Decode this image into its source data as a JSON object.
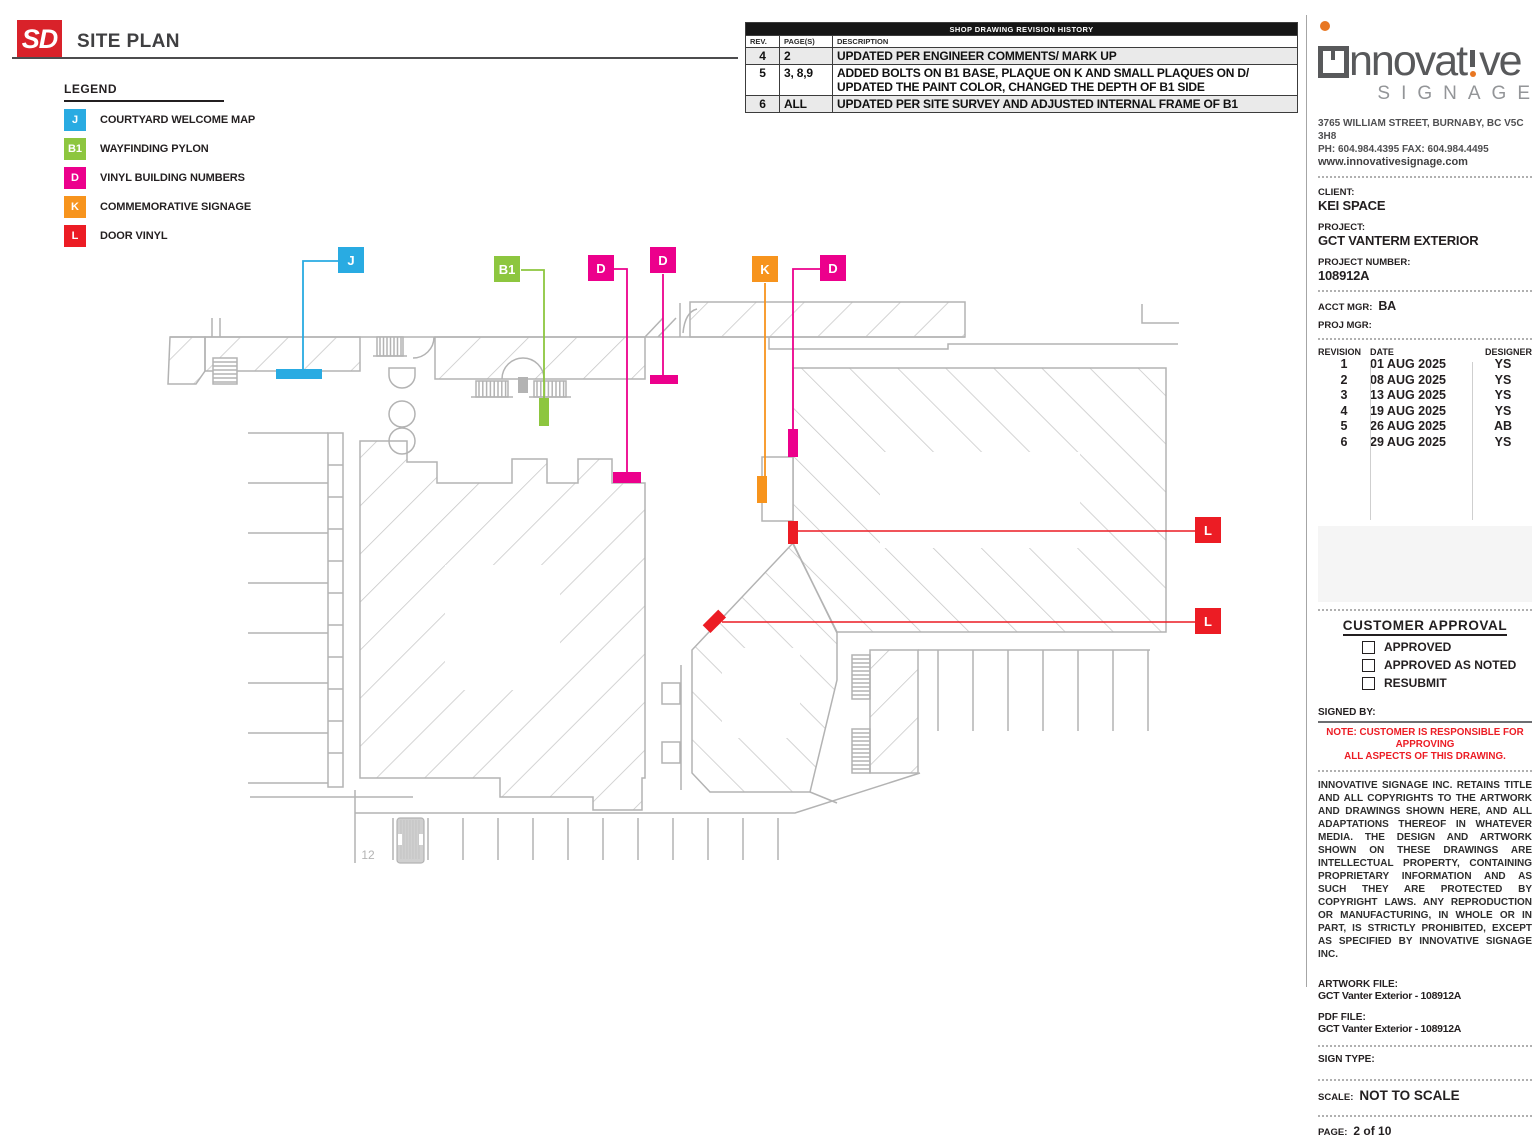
{
  "header": {
    "badge": "SD",
    "title": "SITE PLAN"
  },
  "legend": {
    "title": "LEGEND",
    "items": [
      {
        "code": "J",
        "label": "COURTYARD WELCOME MAP",
        "color": "#29ABE2"
      },
      {
        "code": "B1",
        "label": "WAYFINDING PYLON",
        "color": "#8DC63F"
      },
      {
        "code": "D",
        "label": "VINYL BUILDING NUMBERS",
        "color": "#EC008C"
      },
      {
        "code": "K",
        "label": "COMMEMORATIVE SIGNAGE",
        "color": "#F7941D"
      },
      {
        "code": "L",
        "label": "DOOR VINYL",
        "color": "#EC1C24"
      }
    ]
  },
  "revision_history": {
    "title": "SHOP DRAWING REVISION HISTORY",
    "columns": [
      "REV.",
      "PAGE(S)",
      "DESCRIPTION"
    ],
    "rows": [
      {
        "rev": "4",
        "pages": "2",
        "description": "UPDATED PER ENGINEER COMMENTS/ MARK UP"
      },
      {
        "rev": "5",
        "pages": "3, 8,9",
        "description": "ADDED BOLTS ON B1 BASE, PLAQUE ON K AND SMALL PLAQUES ON D/ UPDATED THE PAINT COLOR, CHANGED THE DEPTH OF B1 SIDE"
      },
      {
        "rev": "6",
        "pages": "ALL",
        "description": "UPDATED PER SITE SURVEY AND ADJUSTED INTERNAL FRAME OF B1"
      }
    ]
  },
  "plan": {
    "stall_number": "12",
    "markers": [
      {
        "code": "J",
        "x": 338,
        "y": 247
      },
      {
        "code": "B1",
        "x": 494,
        "y": 256
      },
      {
        "code": "D",
        "x": 588,
        "y": 255
      },
      {
        "code": "D",
        "x": 650,
        "y": 247
      },
      {
        "code": "K",
        "x": 752,
        "y": 256
      },
      {
        "code": "D",
        "x": 820,
        "y": 255
      },
      {
        "code": "L",
        "x": 1195,
        "y": 517
      },
      {
        "code": "L",
        "x": 1195,
        "y": 608
      }
    ]
  },
  "sidebar": {
    "company": {
      "wordmark": "innovative",
      "tagline": "SIGNAGE",
      "address": "3765 WILLIAM STREET, BURNABY, BC V5C 3H8",
      "phone_fax": "PH: 604.984.4395  FAX: 604.984.4495",
      "website": "www.innovativesignage.com",
      "accent_color": "#E87722",
      "gray_color": "#58595B"
    },
    "client": {
      "label": "CLIENT:",
      "value": "KEI SPACE"
    },
    "project": {
      "label": "PROJECT:",
      "value": "GCT VANTERM EXTERIOR"
    },
    "project_number": {
      "label": "PROJECT NUMBER:",
      "value": "108912A"
    },
    "acct_mgr": {
      "label": "ACCT MGR:",
      "value": "BA"
    },
    "proj_mgr": {
      "label": "PROJ MGR:",
      "value": ""
    },
    "revisions": {
      "columns": [
        "REVISION",
        "DATE",
        "DESIGNER"
      ],
      "rows": [
        {
          "revision": "1",
          "date": "01 AUG 2025",
          "designer": "YS"
        },
        {
          "revision": "2",
          "date": "08 AUG 2025",
          "designer": "YS"
        },
        {
          "revision": "3",
          "date": "13 AUG 2025",
          "designer": "YS"
        },
        {
          "revision": "4",
          "date": "19 AUG 2025",
          "designer": "YS"
        },
        {
          "revision": "5",
          "date": "26 AUG 2025",
          "designer": "AB"
        },
        {
          "revision": "6",
          "date": "29 AUG 2025",
          "designer": "YS"
        }
      ]
    },
    "approval": {
      "title": "CUSTOMER APPROVAL",
      "options": [
        "APPROVED",
        "APPROVED AS NOTED",
        "RESUBMIT"
      ],
      "signed_by_label": "SIGNED BY:",
      "note_line1": "NOTE: CUSTOMER IS RESPONSIBLE FOR APPROVING",
      "note_line2": "ALL ASPECTS OF THIS DRAWING.",
      "note_color": "#EC1C24"
    },
    "legal": "INNOVATIVE SIGNAGE INC. RETAINS TITLE AND ALL COPYRIGHTS TO THE ARTWORK AND DRAWINGS SHOWN HERE, AND ALL ADAPTATIONS THEREOF IN WHATEVER MEDIA. THE DESIGN AND ARTWORK SHOWN ON THESE DRAWINGS ARE INTELLECTUAL PROPERTY, CONTAINING PROPRIETARY INFORMATION AND AS SUCH THEY ARE PROTECTED BY COPYRIGHT LAWS. ANY REPRODUCTION OR MANUFACTURING, IN WHOLE OR IN PART, IS STRICTLY PROHIBITED, EXCEPT AS SPECIFIED BY INNOVATIVE SIGNAGE INC.",
    "artwork_file": {
      "label": "ARTWORK FILE:",
      "value": "GCT Vanter Exterior - 108912A"
    },
    "pdf_file": {
      "label": "PDF FILE:",
      "value": "GCT Vanter Exterior - 108912A"
    },
    "sign_type": {
      "label": "SIGN TYPE:",
      "value": ""
    },
    "scale": {
      "label": "SCALE:",
      "value": "NOT TO SCALE"
    },
    "page": {
      "label": "PAGE:",
      "value": "2 of 10"
    }
  }
}
